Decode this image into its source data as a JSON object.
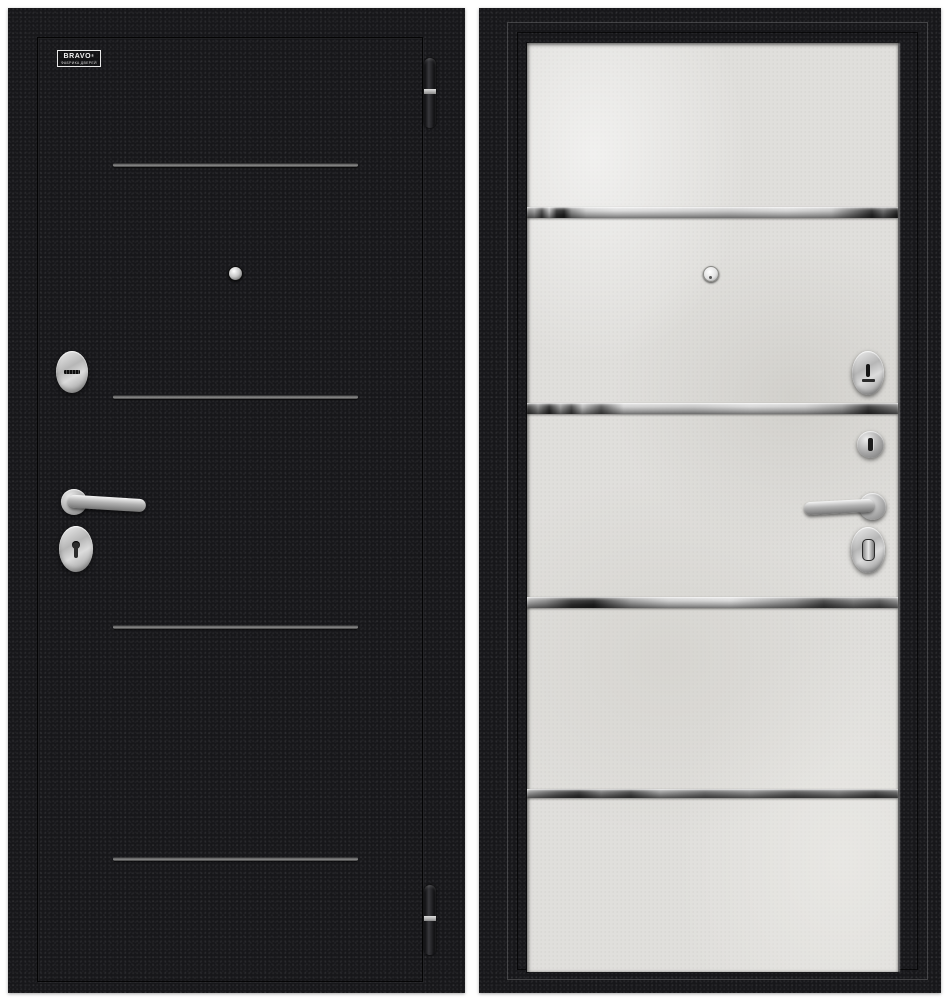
{
  "meta": {
    "type": "product-photo",
    "subject": "Steel entrance door shown from exterior (left) and interior (right) sides",
    "background": "#ffffff"
  },
  "brand": {
    "name": "BRAVO",
    "mark": "®",
    "tagline": "ФАБРИКА ДВЕРЕЙ"
  },
  "exterior_door": {
    "finish": "black boucle",
    "base_color": "#17171a",
    "groove_count": 4,
    "groove_color": "#8e8e8e",
    "hardware_finish": "satin chrome",
    "hardware_color": "#c9c9c9",
    "hinge_count": 2,
    "features": [
      "brand-logo",
      "decor-grooves",
      "peephole",
      "cylinder-escutcheon",
      "lever-handle",
      "keyhole-escutcheon",
      "edge-hinges"
    ]
  },
  "interior_door": {
    "finish": "light concrete (art beton)",
    "panel_color": "#e0dfdc",
    "frame_color": "#17171a",
    "mirror_strip_count": 4,
    "hardware_finish": "satin chrome",
    "hardware_color": "#c9c9c9",
    "features": [
      "mirror-inserts",
      "peephole",
      "cylinder-escutcheon",
      "cylinder-knob",
      "lever-handle",
      "thumbturn-escutcheon"
    ]
  }
}
